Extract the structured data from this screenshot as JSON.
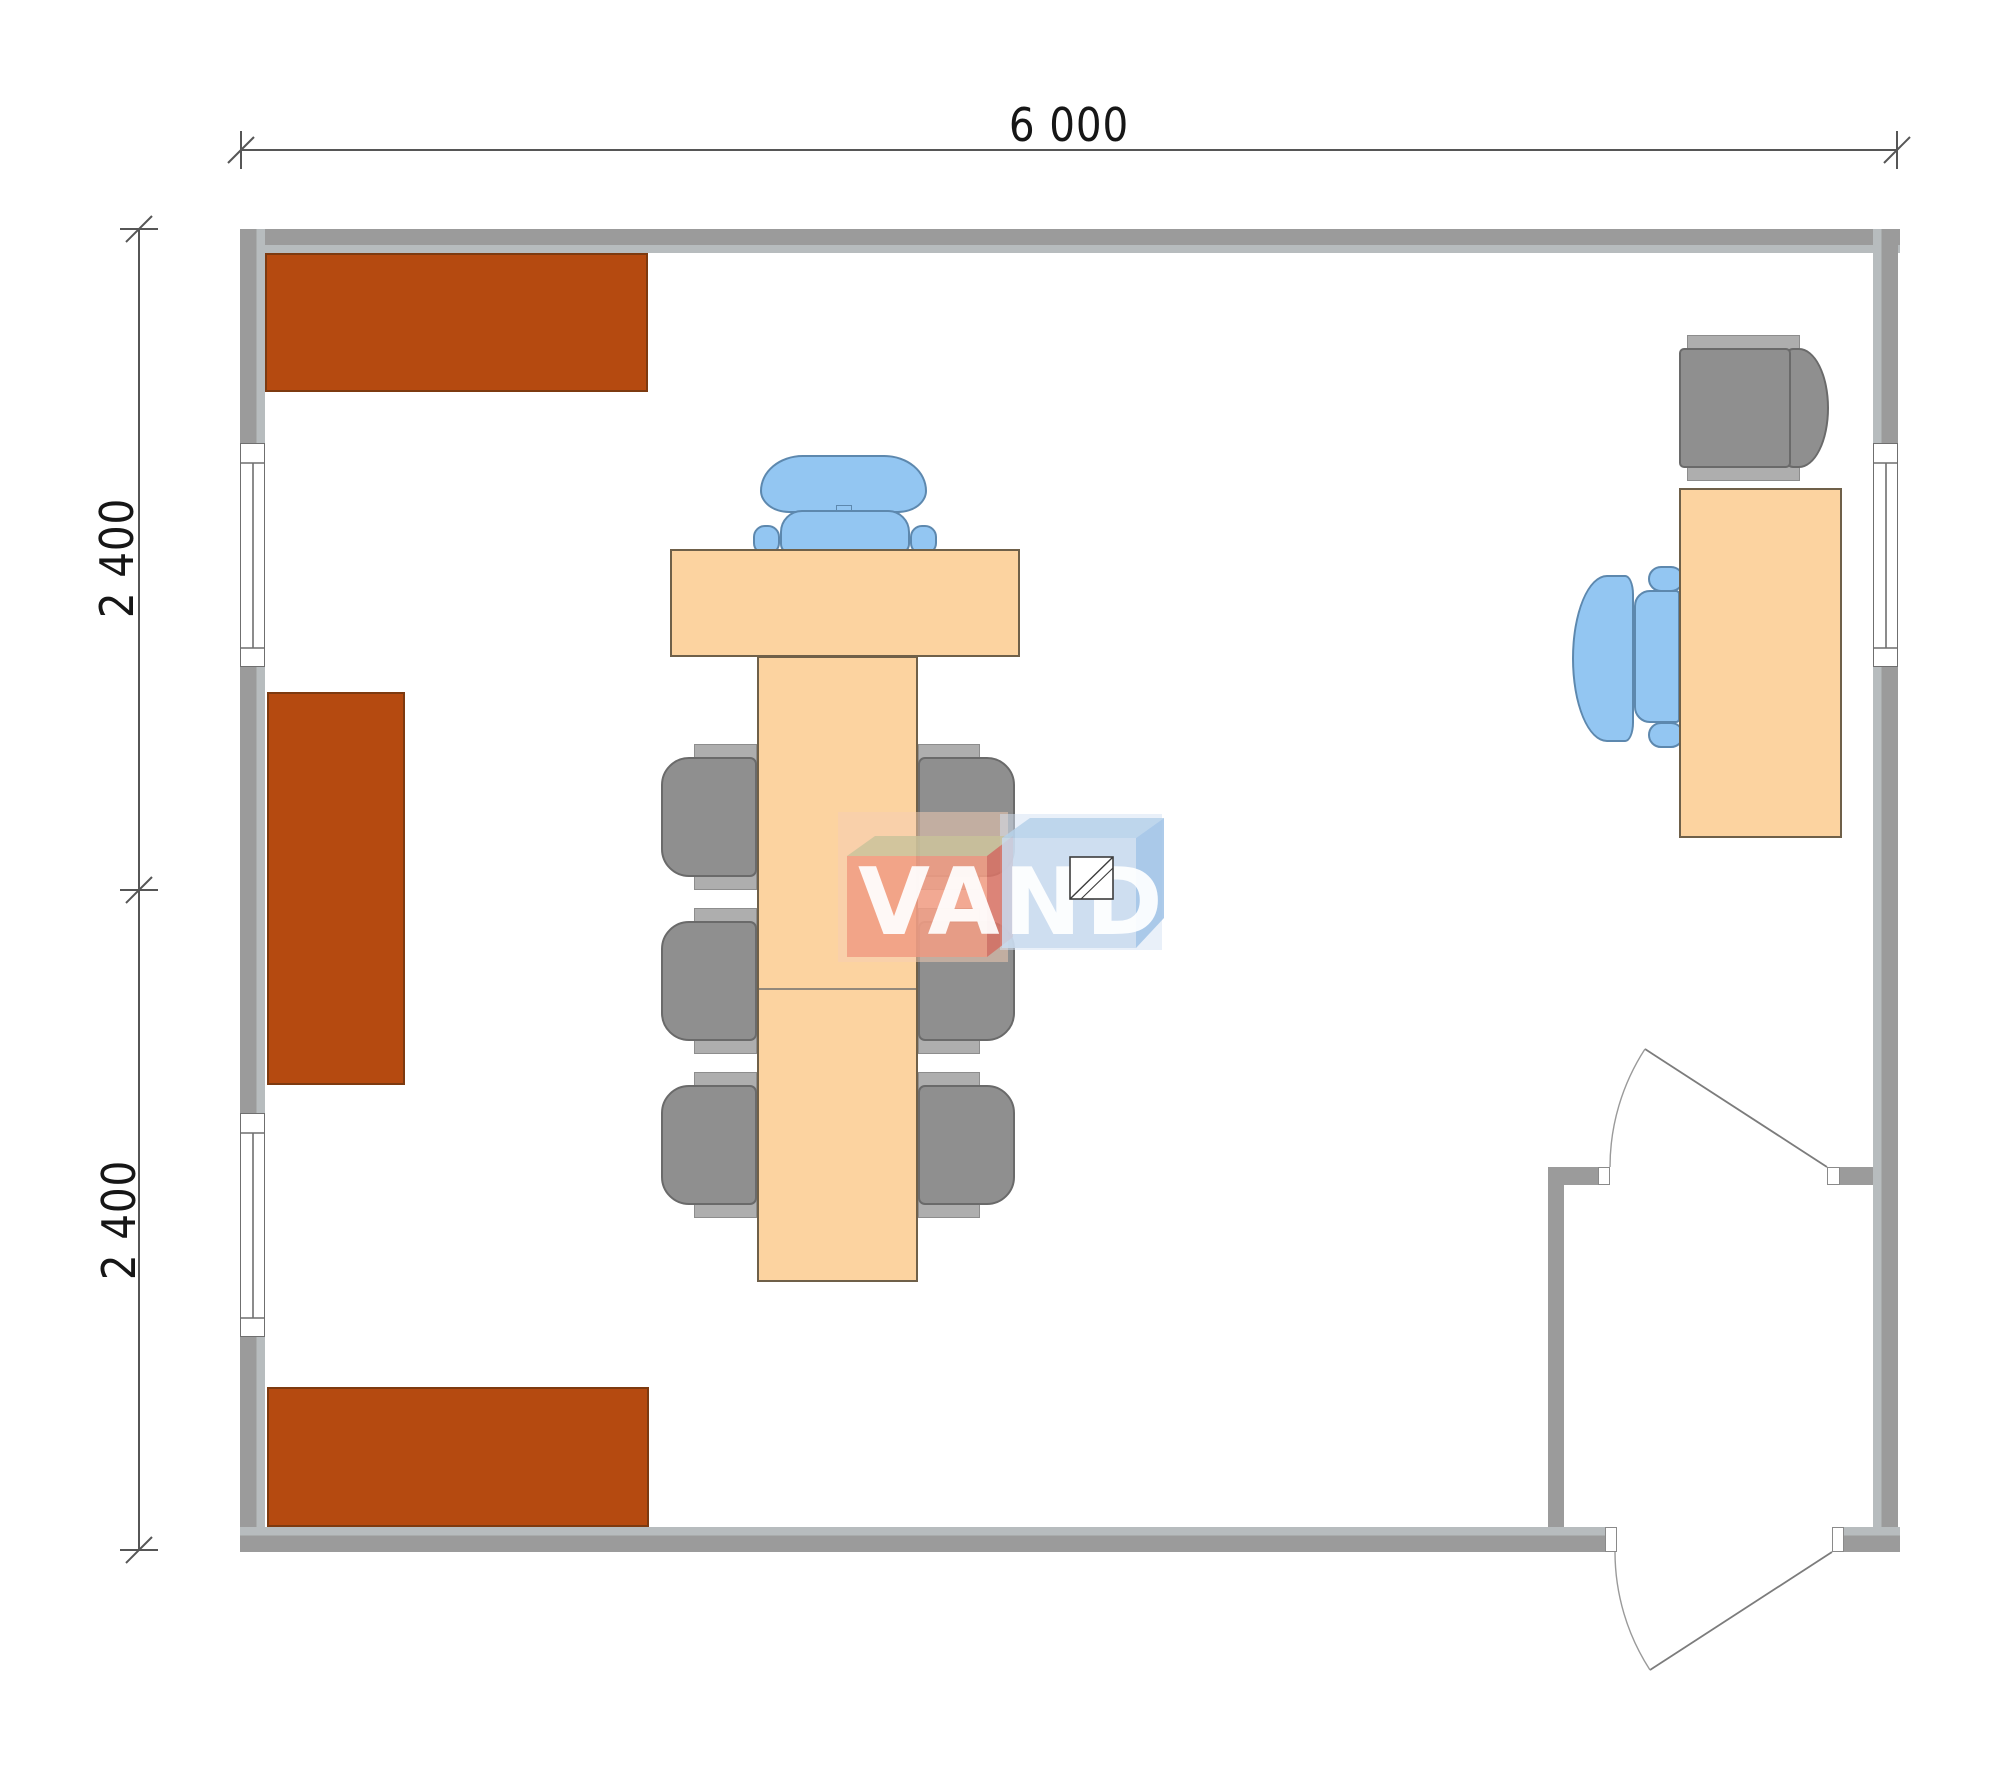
{
  "dimensions": {
    "width_label": "6 000",
    "height_upper_label": "2 400",
    "height_lower_label": "2 400"
  },
  "watermark": {
    "text": "VANDA"
  },
  "colors": {
    "wall": "#9b9b9b",
    "wall_inner": "#b7bcbe",
    "cabinet": "#b54a10",
    "cabinet_border": "#7d3a10",
    "table": "#fcd3a0",
    "table_border": "#6f6049",
    "chair_gray": "#8f8f8f",
    "chair_gray_light": "#aeaeae",
    "chair_gray_border": "#6a6a6a",
    "chair_blue": "#93c6f2",
    "chair_blue_border": "#5d88ae",
    "wm_salmon": "#ef977f",
    "wm_salmon_side": "#d4685c",
    "wm_beige": "#c8c29a",
    "wm_blue_front": "#c9daee",
    "wm_blue_top": "#b6d1ea",
    "wm_blue_side": "#9fc2e6"
  }
}
